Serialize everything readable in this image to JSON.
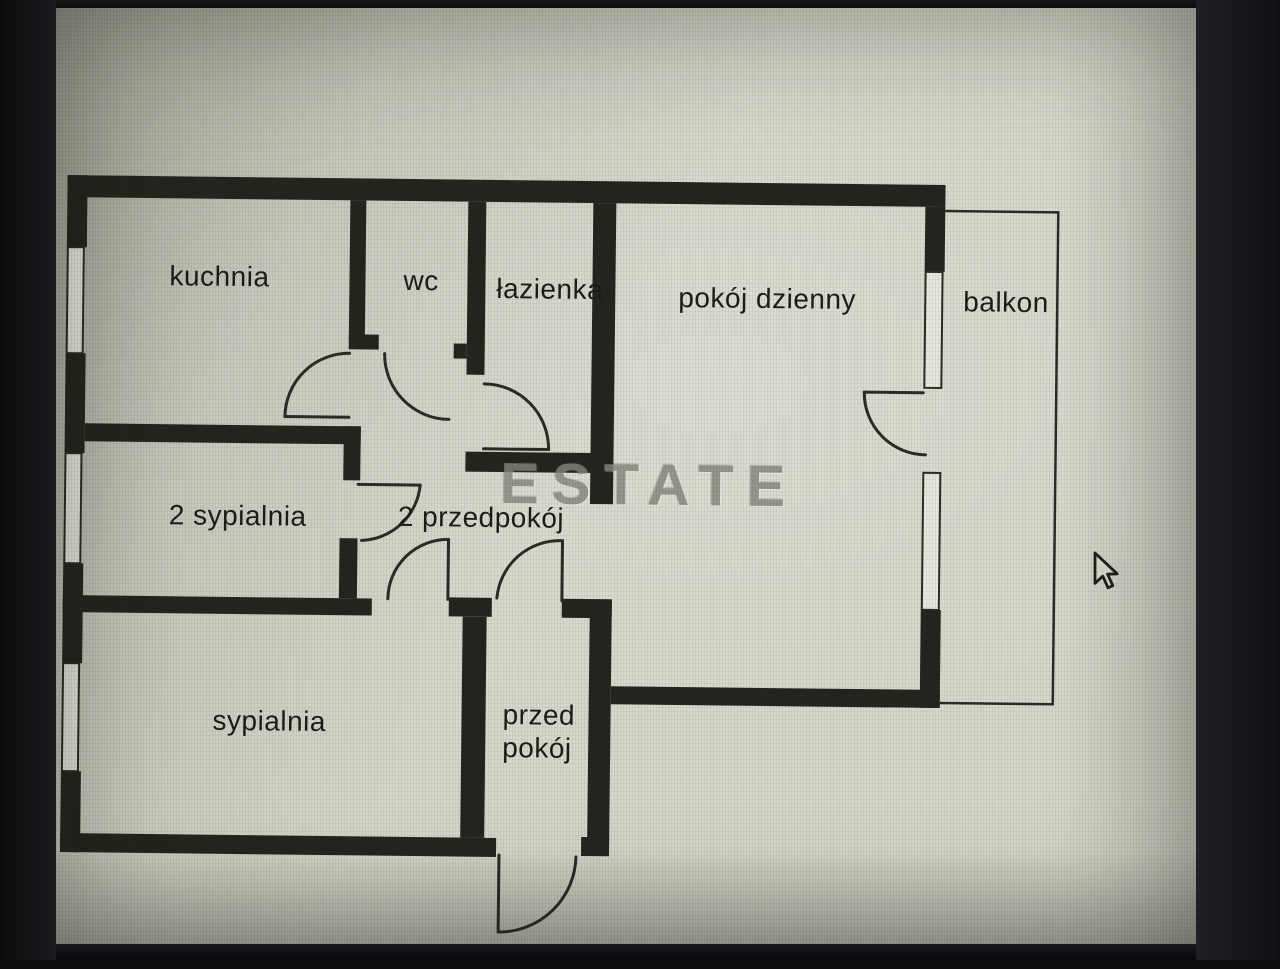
{
  "floorplan": {
    "watermark": "ESTATE",
    "rooms": [
      {
        "label": "kuchnia"
      },
      {
        "label": "wc"
      },
      {
        "label": "łazienka"
      },
      {
        "label": "pokój dzienny"
      },
      {
        "label": "balkon"
      },
      {
        "label": "2 sypialnia"
      },
      {
        "label": "2 przedpokój"
      },
      {
        "label": "sypialnia"
      },
      {
        "label": "przed pokój",
        "line1": "przed",
        "line2": "pokój"
      }
    ]
  },
  "icons": {
    "cursor": "arrow-cursor"
  },
  "colors": {
    "wall": "#24241e",
    "thin_line": "#2b2b25",
    "window_fill": "#e6e7dd",
    "screen_bg": "#d5d7ca",
    "text": "#1b1b18",
    "watermark": "#85877e",
    "frame": "#121215"
  }
}
